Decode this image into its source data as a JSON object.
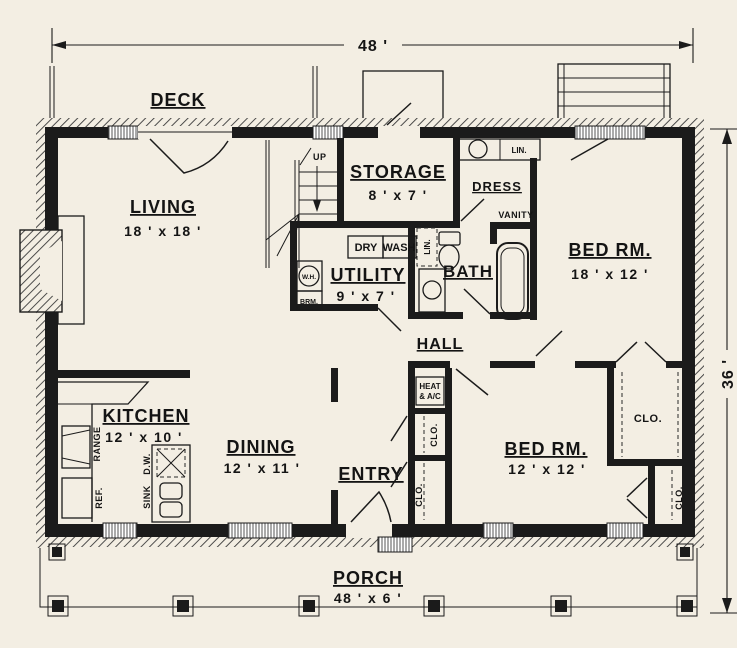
{
  "title": "single-story house floor plan",
  "colors": {
    "paper": "#f3eee3",
    "ink": "#1b1b1b"
  },
  "dimensions": {
    "width": "48 '",
    "depth": "36 '"
  },
  "rooms": {
    "deck": {
      "name": "DECK"
    },
    "storage": {
      "name": "STORAGE",
      "size": "8 ' x 7 '"
    },
    "living": {
      "name": "LIVING",
      "size": "18 ' x 18 '"
    },
    "utility": {
      "name": "UTILITY",
      "size": "9 ' x 7 '"
    },
    "bath": {
      "name": "BATH"
    },
    "dress": {
      "name": "DRESS"
    },
    "hall": {
      "name": "HALL"
    },
    "bedroom1": {
      "name": "BED RM.",
      "size": "18 ' x 12 '"
    },
    "bedroom2": {
      "name": "BED RM.",
      "size": "12 ' x 12 '"
    },
    "kitchen": {
      "name": "KITCHEN",
      "size": "12 ' x 10 '"
    },
    "dining": {
      "name": "DINING",
      "size": "12 ' x 11 '"
    },
    "entry": {
      "name": "ENTRY"
    },
    "porch": {
      "name": "PORCH",
      "size": "48 ' x 6 '"
    }
  },
  "fixtures": {
    "up": "UP",
    "dry": "DRY",
    "wash": "WASH",
    "water_heater": "W.H.",
    "broom": "BRM.",
    "linen_top": "LIN.",
    "linen_bath": "LIN.",
    "vanity": "VANITY",
    "heat_line1": "HEAT",
    "heat_line2": "& A/C",
    "closet_hall_upper": "CLO.",
    "closet_hall_lower": "CLO.",
    "closet_bedroom1": "CLO.",
    "closet_bedroom2": "CLO.",
    "range": "RANGE",
    "refrigerator": "REF.",
    "dishwasher": "D.W.",
    "sink": "SINK"
  }
}
